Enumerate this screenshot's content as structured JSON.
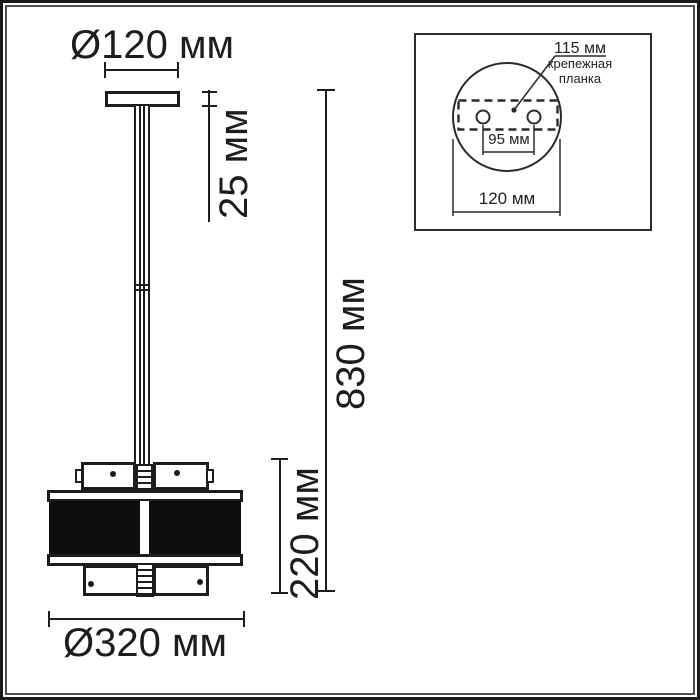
{
  "colors": {
    "ink": "#1d1d1b",
    "line": "#1d1d1b",
    "inset_line": "#2b2b2b",
    "shade_band": "#0e0e0e",
    "background": "#ffffff"
  },
  "main_view": {
    "canopy_diameter_label": "Ø120 мм",
    "canopy_height_label": "25 мм",
    "overall_height_label": "830 мм",
    "shade_height_label": "220 мм",
    "shade_diameter_label": "Ø320 мм"
  },
  "top_view_inset": {
    "plate_length_label": "115 мм",
    "mounting_plate_caption": "крепежная планка",
    "hole_spacing_label": "95 мм",
    "base_diameter_label": "120 мм"
  }
}
